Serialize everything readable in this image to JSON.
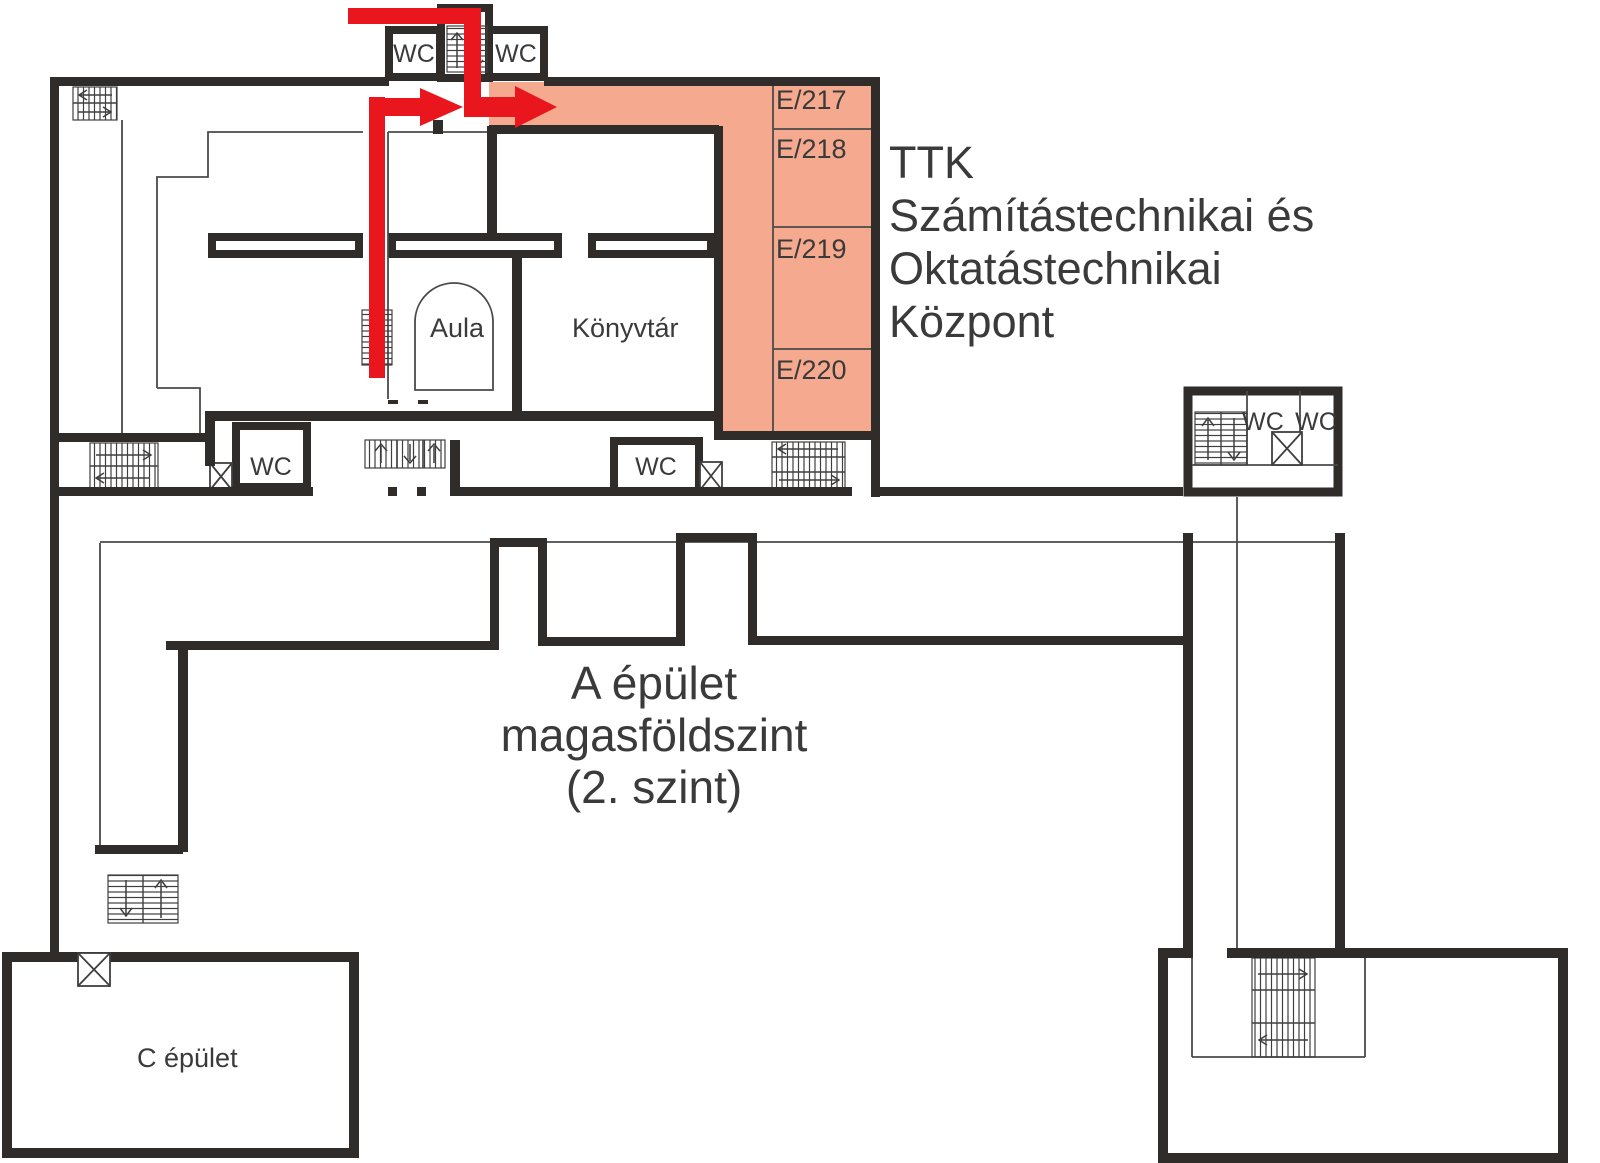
{
  "annotation": {
    "l1": "TTK",
    "l2": "Számítástechnikai és",
    "l3": "Oktatástechnikai",
    "l4": "Központ"
  },
  "center_label": {
    "l1": "A épület",
    "l2": "magasföldszint",
    "l3": "(2. szint)"
  },
  "rooms": {
    "e217": "E/217",
    "e218": "E/218",
    "e219": "E/219",
    "e220": "E/220",
    "aula": "Aula",
    "library": "Könyvtár",
    "c_building": "C épület",
    "wc": "WC"
  },
  "colors": {
    "highlight": "#f5a98f",
    "route": "#ea161e",
    "wall": "#302c2a",
    "thin": "#4a4a4a",
    "text": "#3a3a3a"
  }
}
